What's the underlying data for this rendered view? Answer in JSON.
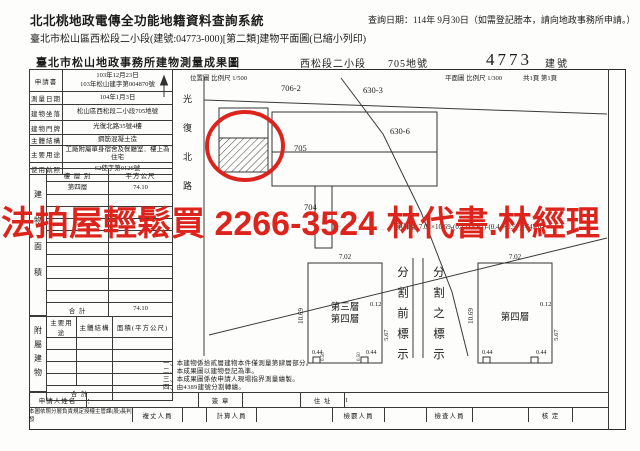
{
  "header": {
    "system_title": "北北桃地政電傳全功能地籍資料查詢系統",
    "query_date": "查詢日期：114年 9月30日（如需登記謄本，請向地政事務所申請。）",
    "subtitle": "臺北市松山區西松段二小段(建號:04773-000)[第二類]建物平面圖(已縮小列印)"
  },
  "doc_header": {
    "office_title": "臺北市松山地政事務所建物測量成果圖",
    "section": "西松段二小段",
    "parcel": "705地號",
    "building_no": "4773",
    "building_no_label": "建號"
  },
  "info_table": {
    "rows": [
      {
        "label": "申請書",
        "value": "103年12月23日\n103年松山建字第004870號"
      },
      {
        "label": "測量日期",
        "value": "104年1月3日"
      },
      {
        "label": "建物坐落",
        "value": "松山區西松段二小段705地號"
      },
      {
        "label": "建物門牌",
        "value": "光復北路35號4樓"
      },
      {
        "label": "主體結構",
        "value": "鋼筋混凝土造"
      },
      {
        "label": "主要用途",
        "value": "工廠附屬單身宿舍及餐廳室．樓上為住宅"
      },
      {
        "label": "使用執照",
        "value": "62使字第0126號"
      }
    ]
  },
  "area": {
    "section_label": "建物面積",
    "header": [
      "樓 層 別",
      "平方公尺"
    ],
    "rows": [
      {
        "floor": "第四層",
        "value": "74.10"
      }
    ],
    "total_label": "合  計",
    "total_value": "74.10"
  },
  "annex": {
    "section_label": "附屬建物",
    "header": [
      "主要用途",
      "主體結構",
      "面積(平方公尺)"
    ],
    "total_label": "合  計"
  },
  "applicant": {
    "label": "申請人姓名",
    "value": "：",
    "sign_label": "簽 章",
    "addr_label": "住 址",
    "addr_value": "1"
  },
  "approval": {
    "note": "本圖依照分層負責規定授權主管課(股)長判發",
    "cells": [
      "複丈人員",
      "計算人員",
      "檢覈人員",
      "檢查人員",
      "核 定"
    ]
  },
  "map": {
    "location_scale": "位置圖 比例尺 1/500",
    "plan_scale": "平面圖 比例尺 1/300",
    "page_info": "共1頁 第1頁",
    "road_name": "光復北路",
    "parcels": {
      "p706": "706-2",
      "p630_3": "630-3",
      "p630_6": "630-6",
      "p705": "705",
      "p704": "704"
    }
  },
  "floor_calc": "第肆層 7.02×10.69-(0.12×5.67)-(0.44×0.57)=74.10",
  "plans": {
    "left_label_1": "第三層",
    "left_label_2": "第四層",
    "right_label": "第四層",
    "divider_left": "分割前標示",
    "divider_right": "分割之標示",
    "dims": {
      "top": "7.02",
      "left": "10.69",
      "right_upper": "0.12",
      "right_lower": "5.67",
      "notch": "0.44",
      "notch_depth": "0.50"
    }
  },
  "notes": [
    "一、本建物係拾貳層建物本件僅測量第肆層部分。",
    "二、本成果圖以建物登記為準。",
    "三、本成果圖係依申請人現場指界測量繪製。",
    "四、由4389建號分割轉繪。"
  ],
  "watermark": {
    "text": "法拍屋輕鬆買 2266-3524 林代書.林經理",
    "color": "#dd241c"
  }
}
